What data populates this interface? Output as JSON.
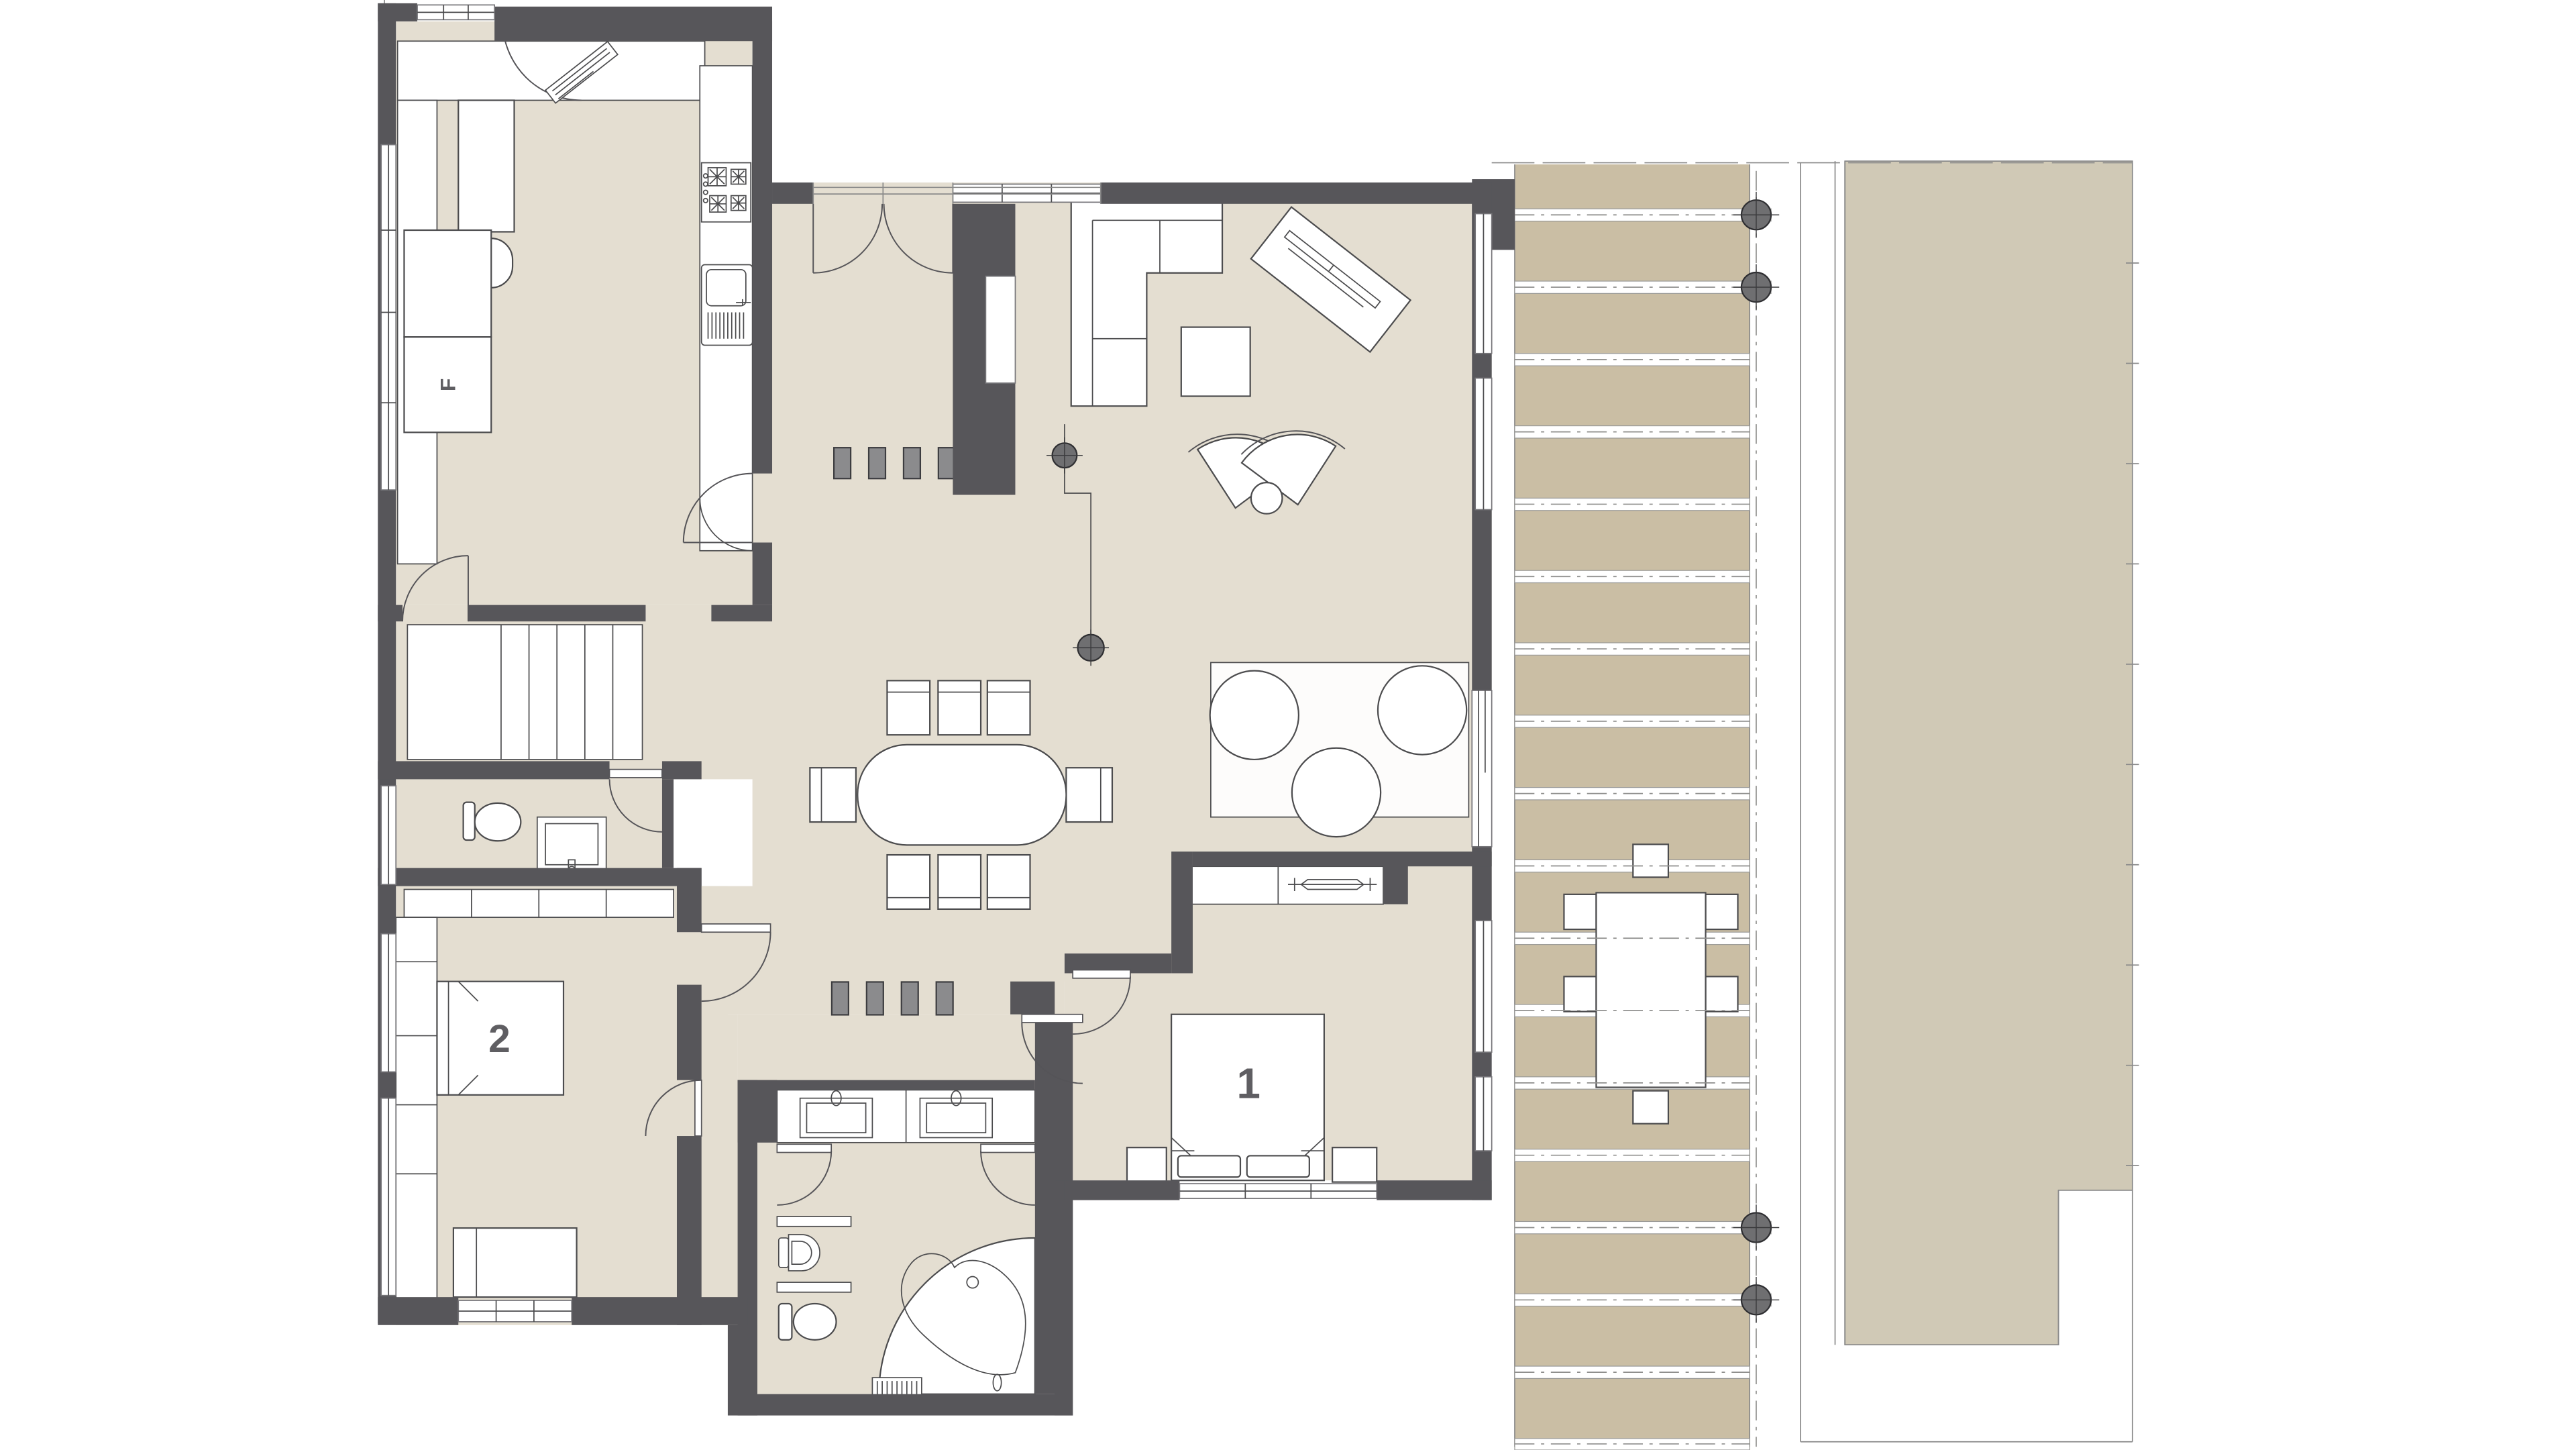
{
  "floorplan": {
    "room_labels": {
      "bedroom1": "1",
      "bedroom2": "2",
      "fridge": "F"
    },
    "colors": {
      "wall": "#57565a",
      "floor": "#e4ded1",
      "deck": "#cabea4",
      "lawn": "#d0c9b6",
      "fixture": "#ffffff",
      "stroke": "#4c4c4e",
      "block": "#8b8b8d",
      "post": "#6f6f71",
      "label": "#5f5e62"
    }
  }
}
